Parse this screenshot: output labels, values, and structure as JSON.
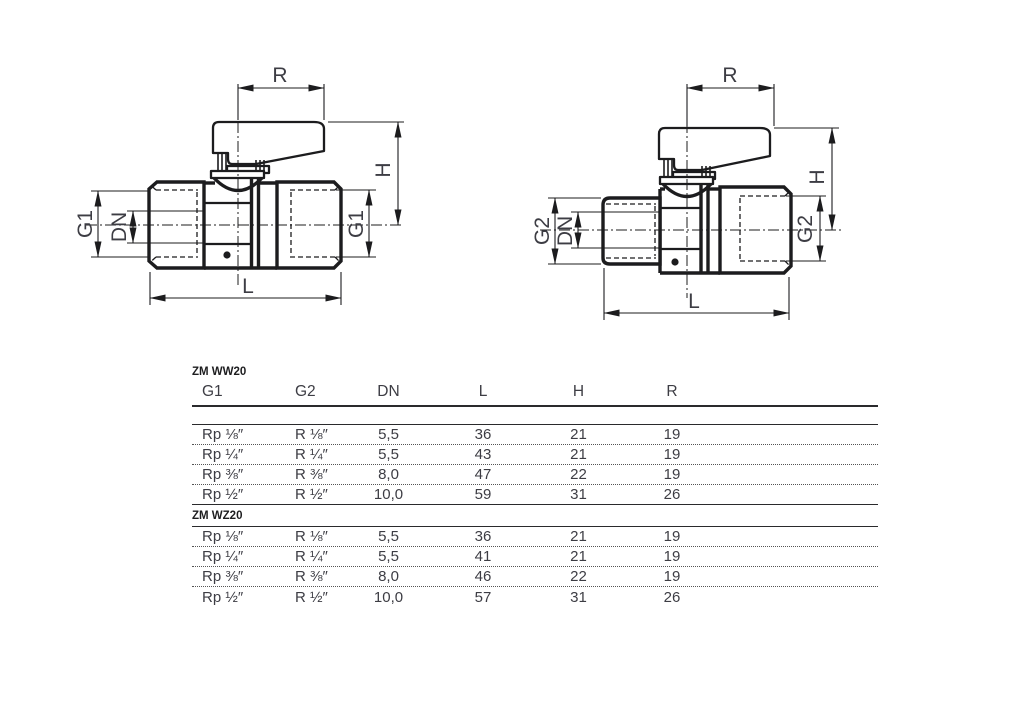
{
  "colors": {
    "ink": "#1c1c1e",
    "text": "#3d3d44",
    "background": "#ffffff"
  },
  "diagrams": [
    {
      "name": "ball-valve-female-female",
      "dim_labels": {
        "r": "R",
        "h": "H",
        "l": "L",
        "dn": "DN",
        "g_left": "G1",
        "g_right": "G1"
      }
    },
    {
      "name": "ball-valve-male-female",
      "dim_labels": {
        "r": "R",
        "h": "H",
        "l": "L",
        "dn": "DN",
        "g_left": "G2",
        "g_right": "G2"
      }
    }
  ],
  "tables": [
    {
      "title": "ZM WW20",
      "columns": [
        "G1",
        "G2",
        "DN",
        "L",
        "H",
        "R"
      ],
      "rows": [
        [
          "Rp ⅛″",
          "R ⅛″",
          "5,5",
          "36",
          "21",
          "19"
        ],
        [
          "Rp ¼″",
          "R ¼″",
          "5,5",
          "43",
          "21",
          "19"
        ],
        [
          "Rp ⅜″",
          "R ⅜″",
          "8,0",
          "47",
          "22",
          "19"
        ],
        [
          "Rp ½″",
          "R ½″",
          "10,0",
          "59",
          "31",
          "26"
        ]
      ]
    },
    {
      "title": "ZM WZ20",
      "rows": [
        [
          "Rp ⅛″",
          "R ⅛″",
          "5,5",
          "36",
          "21",
          "19"
        ],
        [
          "Rp ¼″",
          "R ¼″",
          "5,5",
          "41",
          "21",
          "19"
        ],
        [
          "Rp ⅜″",
          "R ⅜″",
          "8,0",
          "46",
          "22",
          "19"
        ],
        [
          "Rp ½″",
          "R ½″",
          "10,0",
          "57",
          "31",
          "26"
        ]
      ]
    }
  ]
}
